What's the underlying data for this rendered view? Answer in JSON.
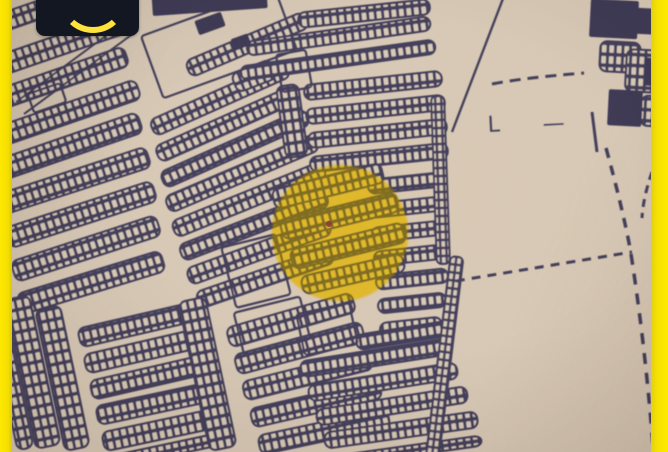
{
  "brand": {
    "logo_text": "SAKAN",
    "logo_icon": "smile-arc-icon",
    "logo_bg_color": "#121722",
    "logo_accent_color": "#ffe23c"
  },
  "map": {
    "kind": "photographed cadastral plot map",
    "paper_color": "#d8c9b6",
    "ink_color": "#45415c",
    "frame_stripe_color": "#f6e300",
    "highlight_circle": {
      "shape": "circle",
      "color": "#f2c824",
      "center_x": 340,
      "center_y": 233,
      "radius": 68
    },
    "marker_dot": {
      "shape": "dot",
      "color": "#8e3a36",
      "x": 329,
      "y": 224
    },
    "symbols": [
      {
        "glyph": "L"
      },
      {
        "glyph": "—"
      }
    ]
  }
}
